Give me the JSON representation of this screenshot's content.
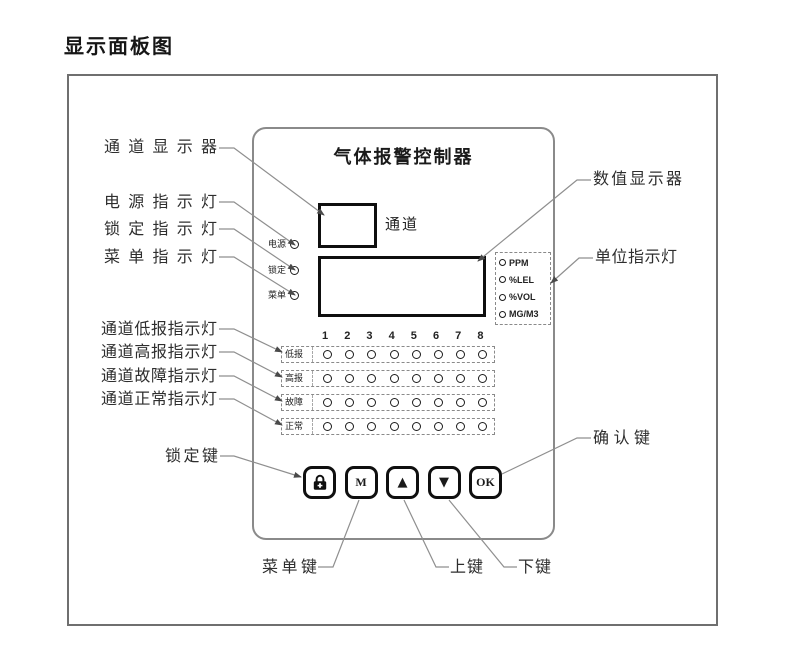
{
  "page": {
    "title": "显示面板图"
  },
  "panel": {
    "title": "气体报警控制器",
    "channel_display_label": "通道",
    "status_leds": [
      "电源",
      "锁定",
      "菜单"
    ],
    "unit_leds": [
      "PPM",
      "%LEL",
      "%VOL",
      "MG/M3"
    ],
    "channels": [
      "1",
      "2",
      "3",
      "4",
      "5",
      "6",
      "7",
      "8"
    ],
    "alarm_rows": [
      "低报",
      "高报",
      "故障",
      "正常"
    ],
    "buttons": {
      "menu": "M",
      "up": "▲",
      "down": "▼",
      "ok": "OK"
    }
  },
  "callouts": {
    "channel_display": "通道显示器",
    "power_led": "电源指示灯",
    "lock_led": "锁定指示灯",
    "menu_led": "菜单指示灯",
    "value_display": "数值显示器",
    "unit_led": "单位指示灯",
    "low_alarm_led": "通道低报指示灯",
    "high_alarm_led": "通道高报指示灯",
    "fault_led": "通道故障指示灯",
    "normal_led": "通道正常指示灯",
    "lock_key": "锁定键",
    "menu_key": "菜单键",
    "up_key": "上键",
    "down_key": "下键",
    "ok_key": "确认键"
  },
  "colors": {
    "leader_line": "#8f8f8f",
    "panel_border": "#8a8a8a",
    "display_border": "#0f0f0f",
    "text": "#2e2e2e"
  }
}
